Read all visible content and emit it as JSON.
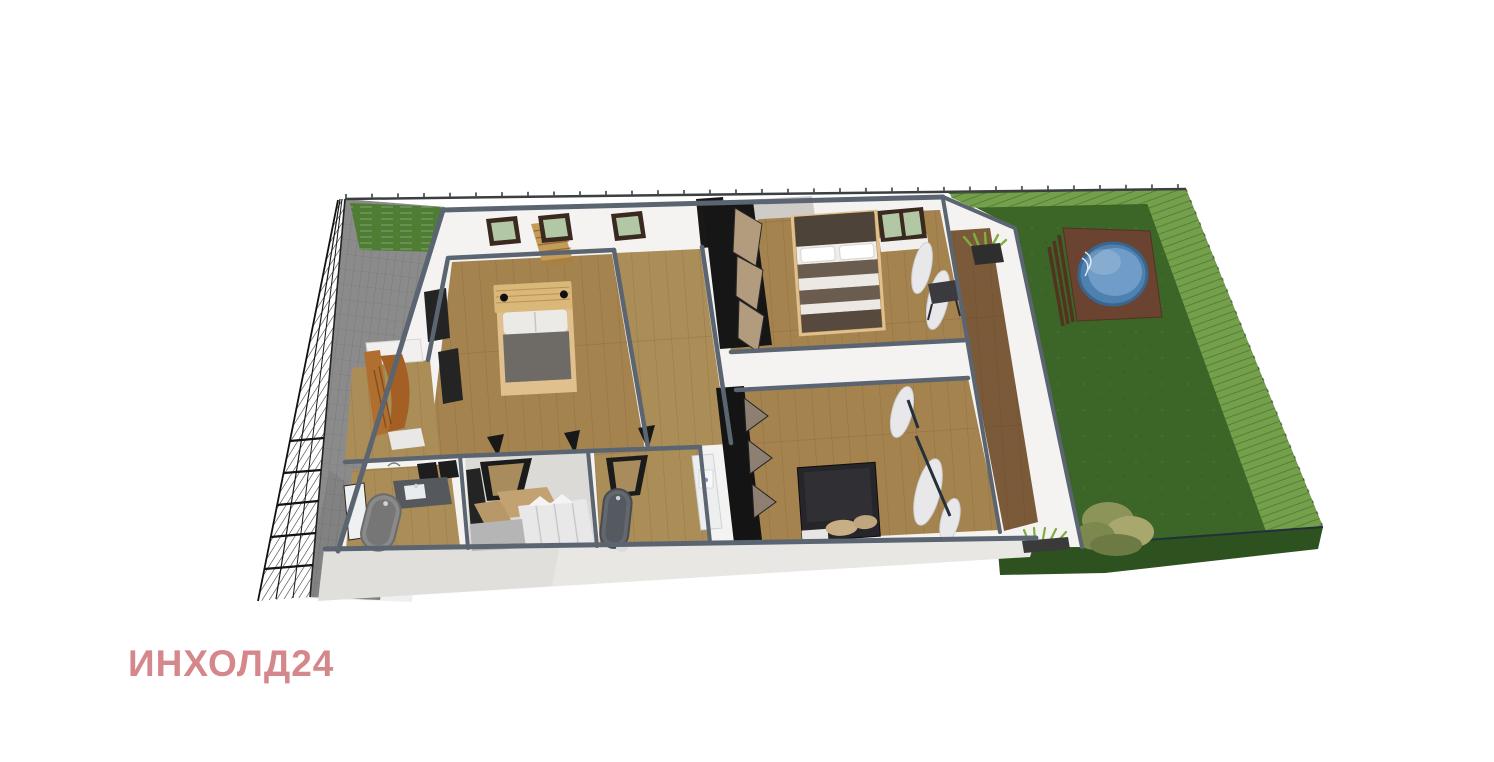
{
  "watermark": {
    "text": "ИНХОЛД24"
  },
  "scene": {
    "description": "3D isometric cut-away rendering of a single-storey house plan on a fenced plot with paved driveway, rear garden and round pool",
    "objects": [
      "perimeter-fence-left",
      "perimeter-fence-top",
      "paved-driveway",
      "front-lawn-patch",
      "garden-lawn",
      "garden-hedge",
      "pool-deck",
      "round-pool",
      "pool-ladder",
      "garden-bush",
      "house-shell",
      "staircase",
      "window",
      "bedroom-1-bed",
      "bedroom-2-bed",
      "bedroom-3-bed",
      "corridor",
      "wardrobe-cabinet",
      "entry-coat-rack",
      "bathtub",
      "vanity-sink",
      "walk-in-closet-shelving",
      "terrace-deck",
      "planter-box",
      "curtains"
    ]
  },
  "colors": {
    "background": "#ffffff",
    "watermark": "#d4888b",
    "wallCap": "#5b6571",
    "wallLight": "#f4f3f1",
    "wallShade": "#e9e7e4",
    "floorWood": "#a5834f",
    "corridorWood": "#ab8d58",
    "terraceWood": "#7b5a3a",
    "grassDark": "#3c6528",
    "grassLight": "#74a04c",
    "grassSide": "#2d511f",
    "grassPatch": "#4e7d33",
    "paving": "#8b8b8b",
    "fenceLine": "#1f1f1f",
    "poolWater": "#4e80b0",
    "poolWaterLight": "#6f9cc8",
    "deckBrown": "#6b4331",
    "bushOlive": "#9aa061",
    "plantGreen": "#7fae3f",
    "bedDuvet": "#6e6a66",
    "bedFrameTan": "#e0c08c",
    "headboardBrown": "#4d4339",
    "bedBlack": "#26262a",
    "pillowWhite": "#eceae6",
    "tubGray": "#8a8a8a",
    "tubDark": "#62686d",
    "counterDark": "#55585c",
    "doorBlack": "#181818",
    "doorTan": "#b39b7e",
    "windowFrame": "#39291f",
    "windowGlass": "#b2c7a4",
    "marble": "#cfccc8",
    "curtain": "#e8e8ea",
    "furnitureOrange": "#b06f2f",
    "stairTan": "#c59b58"
  }
}
